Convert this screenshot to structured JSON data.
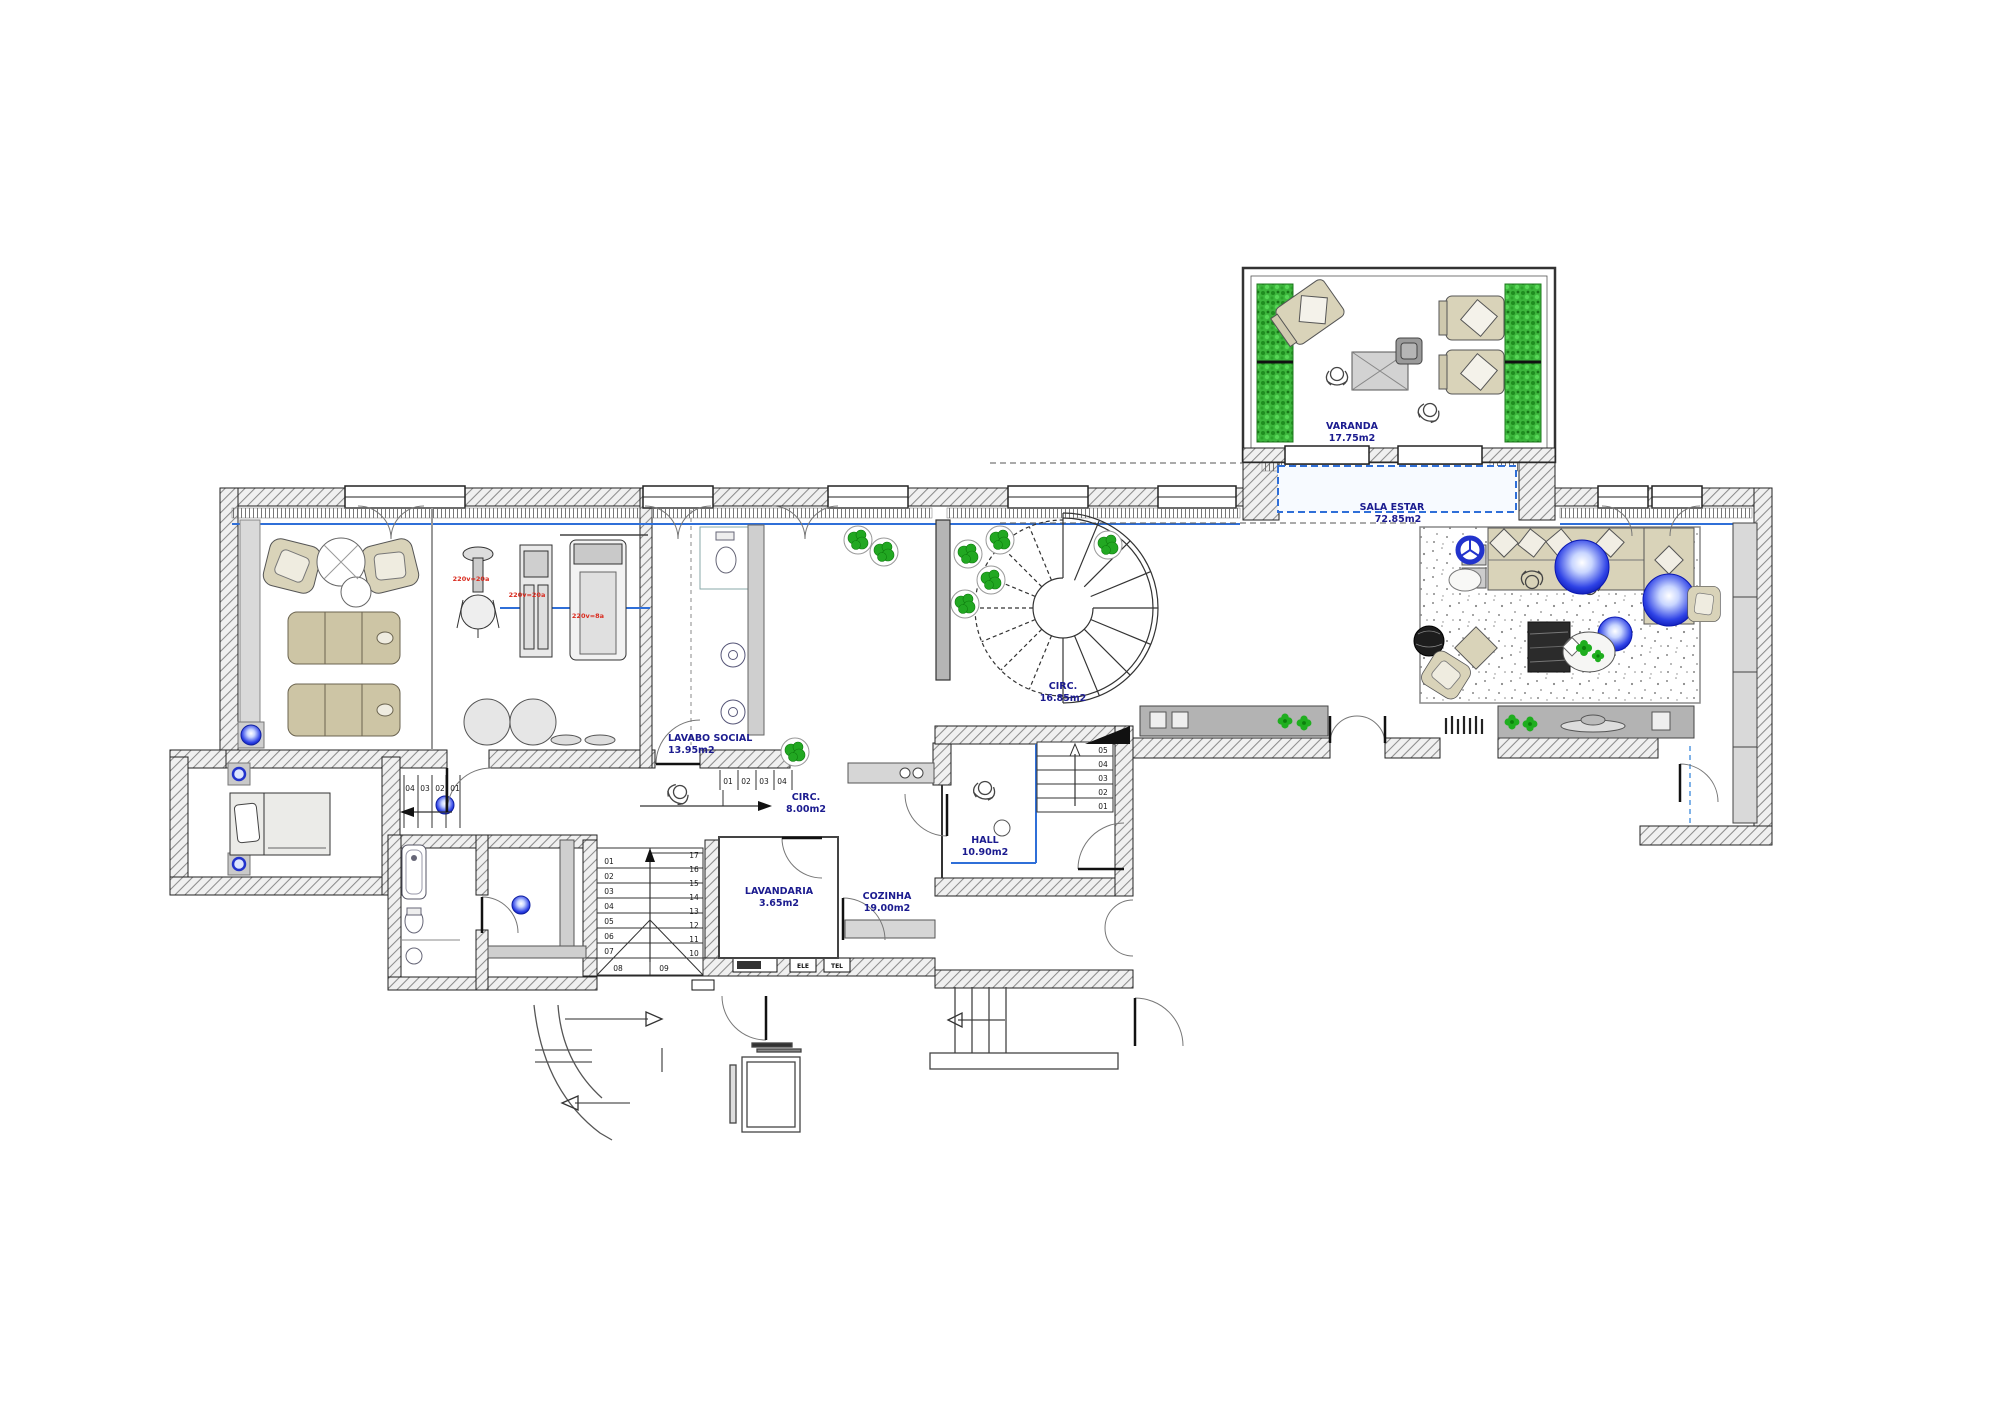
{
  "plan": {
    "rooms": {
      "varanda": {
        "name": "VARANDA",
        "area": "17.75m2"
      },
      "sala_estar": {
        "name": "SALA ESTAR",
        "area": "72.85m2"
      },
      "lavabo_social": {
        "name": "LAVABO SOCIAL",
        "area": "13.95m2"
      },
      "circ_escada": {
        "name": "CIRC.",
        "area": "16.85m2"
      },
      "circ_corredor": {
        "name": "CIRC.",
        "area": "8.00m2"
      },
      "hall": {
        "name": "HALL",
        "area": "10.90m2"
      },
      "lavandaria": {
        "name": "LAVANDARIA",
        "area": "3.65m2"
      },
      "cozinha": {
        "name": "COZINHA",
        "area": "19.00m2"
      }
    },
    "equipment": {
      "bike_power": "220v=20a",
      "station_power": "220v=20a",
      "treadmill_power": "220v=8a"
    },
    "stairs": {
      "main_left": [
        "01",
        "02",
        "03",
        "04",
        "05",
        "06",
        "07"
      ],
      "main_right": [
        "17",
        "16",
        "15",
        "14",
        "13",
        "12",
        "11",
        "10"
      ],
      "main_landing": [
        "08",
        "09"
      ],
      "corridor": [
        "01",
        "02",
        "03",
        "04"
      ],
      "bedroom": [
        "04",
        "03",
        "02",
        "01"
      ],
      "hall": [
        "05",
        "04",
        "03",
        "02",
        "01"
      ]
    },
    "utility_boxes": [
      "ELE",
      "TEL"
    ],
    "colors": {
      "label": "#1b1b8f",
      "red": "#d92b1f",
      "green": "#2eb52e",
      "blue_line": "#2f6fd8",
      "ball_blue": "#1022cc",
      "beige": "#d9d3b9",
      "wall_hatch": "#8c8c8c"
    }
  }
}
